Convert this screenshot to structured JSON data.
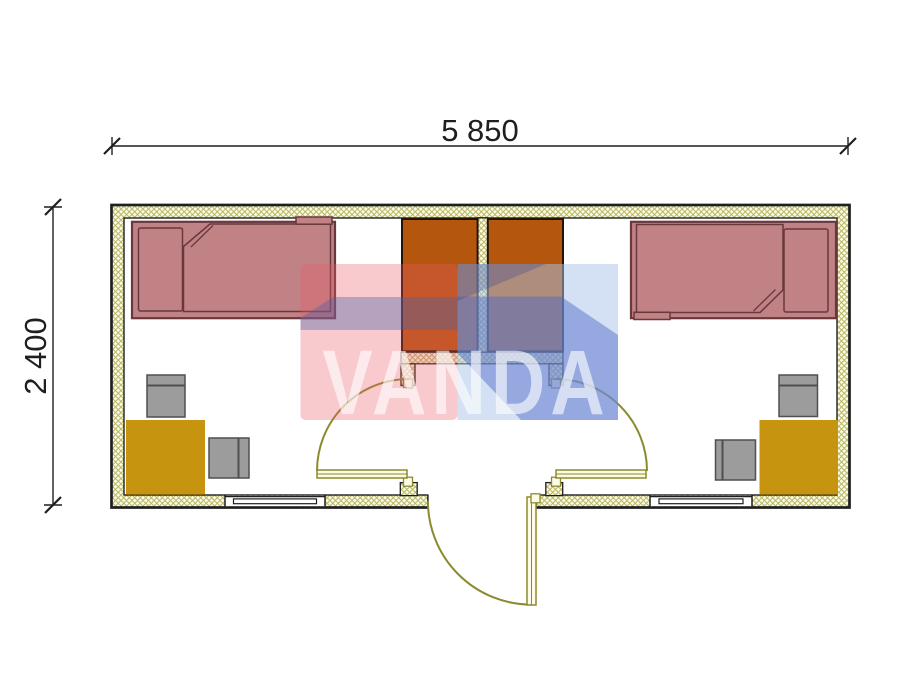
{
  "app": {
    "type": "architectural-floor-plan"
  },
  "dimensions": {
    "width_label": "5 850",
    "height_label": "2 400"
  },
  "watermark": {
    "text": "VANDA"
  },
  "colors": {
    "outline": "#1f1f1f",
    "wall_fill": "#fcfbe6",
    "wall_hatch": "#b9b869",
    "door": "#8b8b2e",
    "bed": "#c18286",
    "bed_border": "#68383d",
    "wardrobe": "#b5560f",
    "wardrobe_border": "#231307",
    "desk": "#c79410",
    "chair": "#9c9c9c",
    "chair_border": "#4f4f4f",
    "wm_pink": "#e85966",
    "wm_band": "#4a5fa5",
    "wm_blue_light": "#a9c4e9",
    "wm_blue": "#4a66c8",
    "wm_blue_dark": "#2b3f96",
    "wm_text": "#ffffff"
  }
}
